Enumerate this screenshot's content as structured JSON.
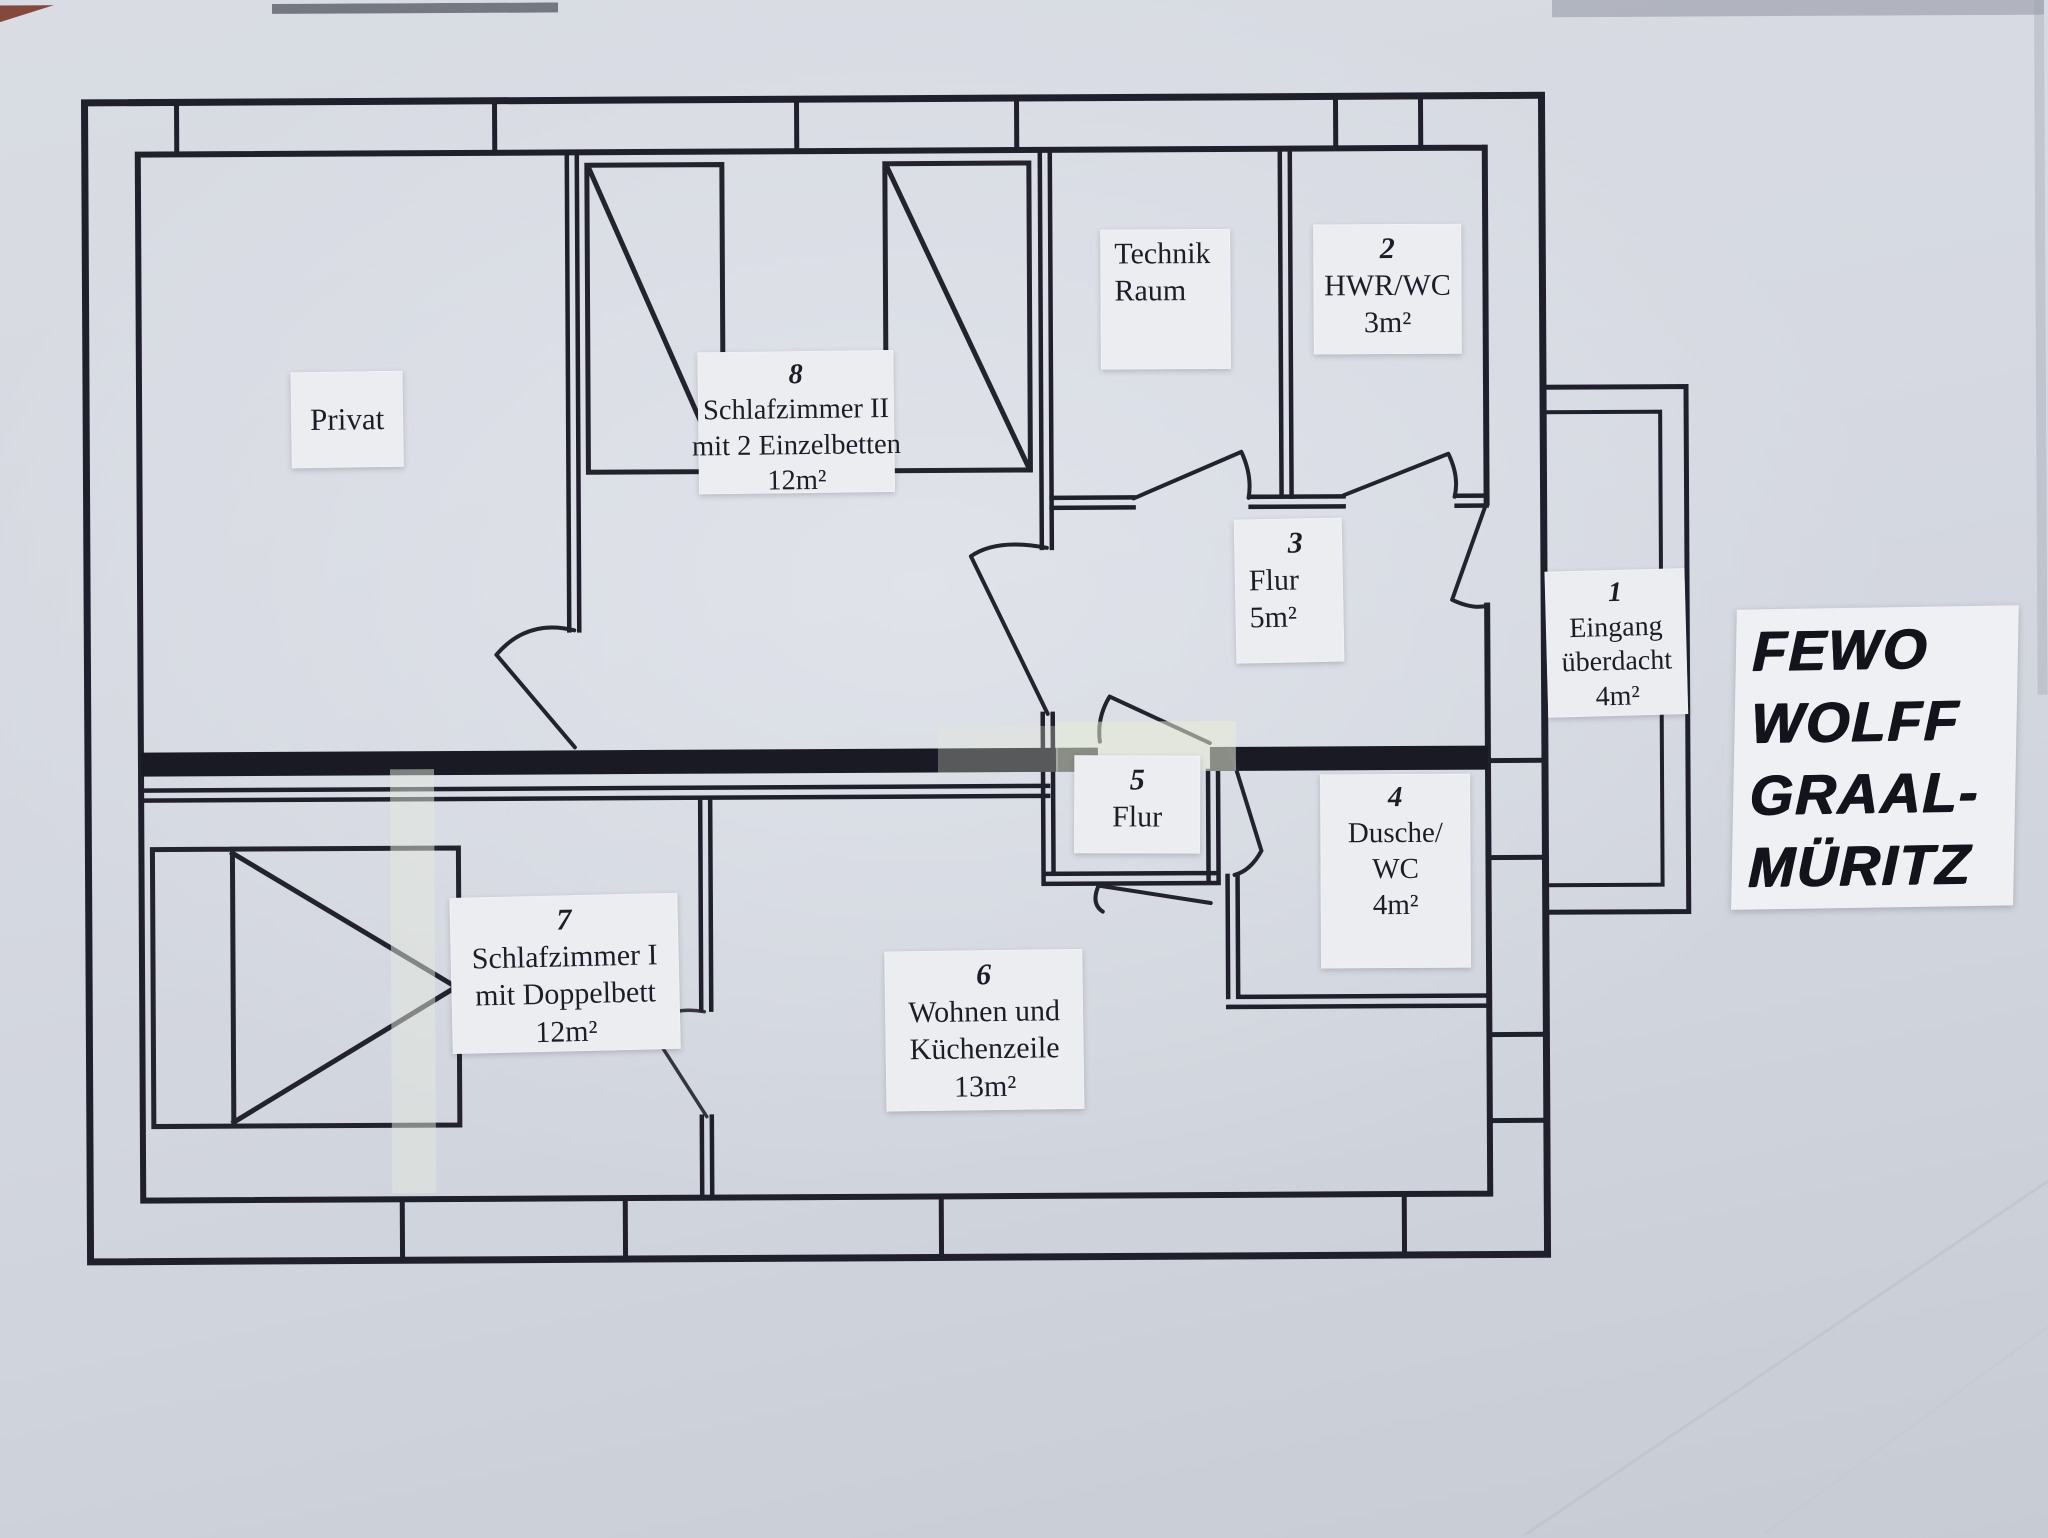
{
  "document": {
    "type": "floor-plan photo",
    "colors": {
      "paper": "#d6d9e1",
      "ink": "#20202c",
      "sticker": "#ecedf1"
    }
  },
  "labels": {
    "privat": {
      "lines": [
        "Privat"
      ]
    },
    "schlafzimmer2": {
      "lines": [
        "8",
        "Schlafzimmer II",
        "mit 2 Einzelbetten",
        "12m²"
      ]
    },
    "technik": {
      "lines": [
        "Technik",
        "Raum"
      ]
    },
    "hwr": {
      "lines": [
        "2",
        "HWR/WC",
        "3m²"
      ]
    },
    "flur3": {
      "lines": [
        "3",
        "Flur",
        "5m²"
      ]
    },
    "eingang": {
      "lines": [
        "1",
        "Eingang",
        "überdacht",
        "4m²"
      ]
    },
    "flur5": {
      "lines": [
        "5",
        "Flur"
      ]
    },
    "dusche": {
      "lines": [
        "4",
        "Dusche/",
        "WC",
        "4m²"
      ]
    },
    "schlafzimmer1": {
      "lines": [
        "7",
        "Schlafzimmer I",
        "mit Doppelbett",
        "12m²"
      ]
    },
    "wohnen": {
      "lines": [
        "6",
        "Wohnen und",
        "Küchenzeile",
        "13m²"
      ]
    },
    "title": {
      "lines": [
        "FEWO",
        "WOLFF",
        "GRAAL-",
        "MÜRITZ"
      ]
    }
  }
}
